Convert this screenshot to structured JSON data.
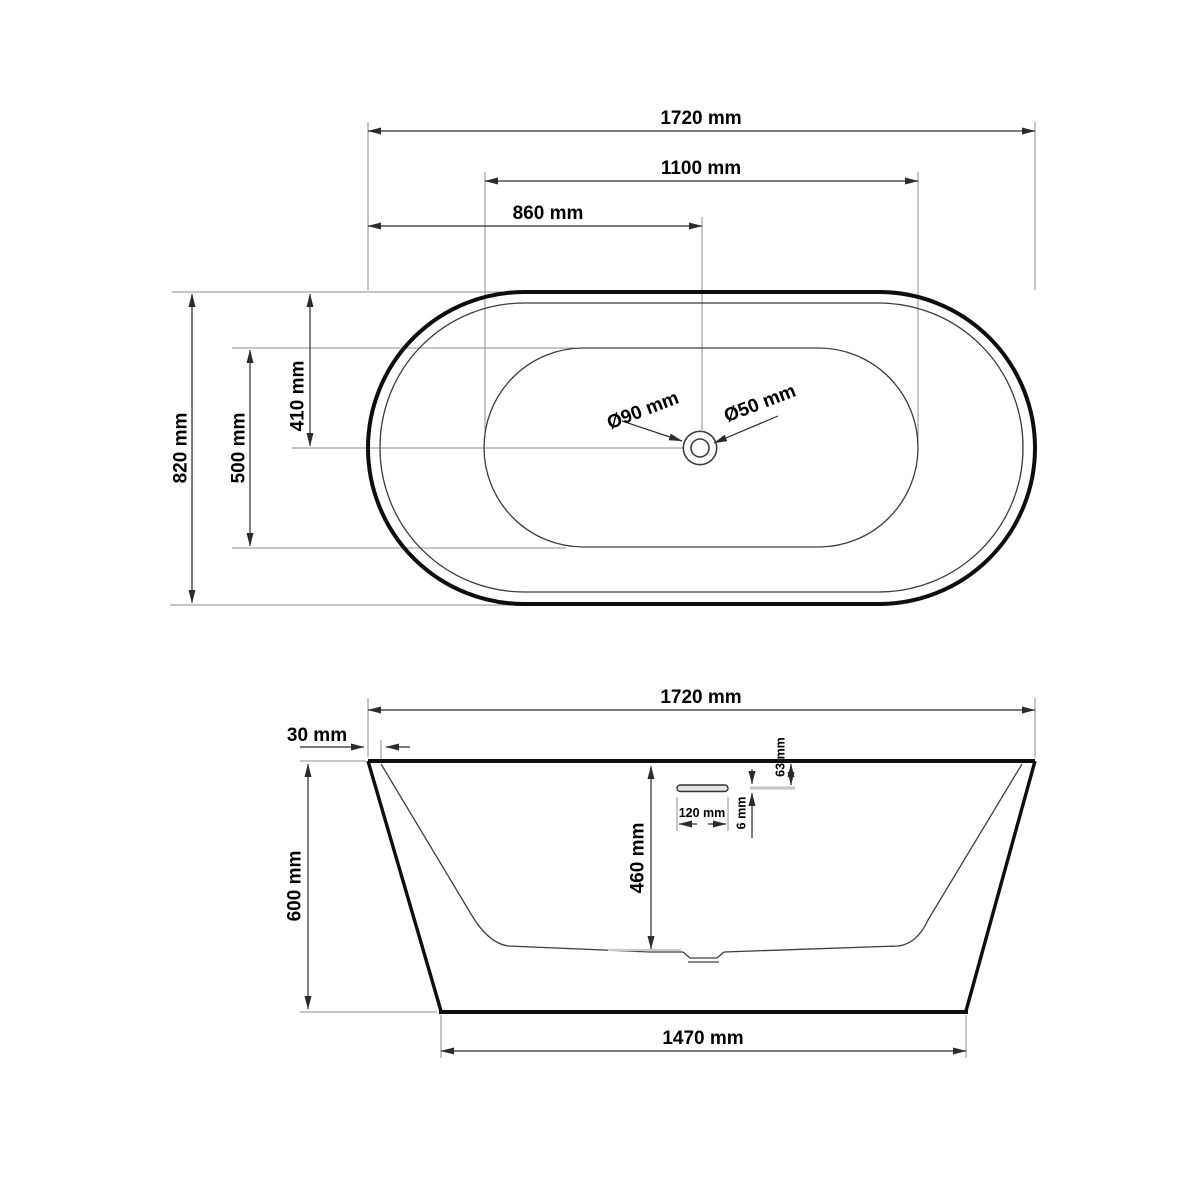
{
  "diagram": {
    "subject": "freestanding oval bathtub technical drawing",
    "unit": "mm",
    "colors": {
      "outline": "#0e0e0e",
      "dimension_lines": "#2b2b2b",
      "extension_lines": "#8e8e8e",
      "background": "#ffffff"
    },
    "top_view": {
      "length_overall": "1720 mm",
      "length_inner_basin": "1100 mm",
      "length_to_drain_center": "860 mm",
      "width_overall": "820 mm",
      "width_inner_basin": "500 mm",
      "width_to_center": "410 mm",
      "drain_outer_diameter": "Ø90 mm",
      "drain_inner_diameter": "Ø50 mm"
    },
    "side_view": {
      "length_overall": "1720 mm",
      "rim_lip_width": "30 mm",
      "height_overall": "600 mm",
      "depth_inner": "460 mm",
      "overflow_slot_width": "120 mm",
      "overflow_distance_from_rim": "63 mm",
      "overflow_slot_height": "6 mm",
      "base_length": "1470 mm"
    }
  }
}
